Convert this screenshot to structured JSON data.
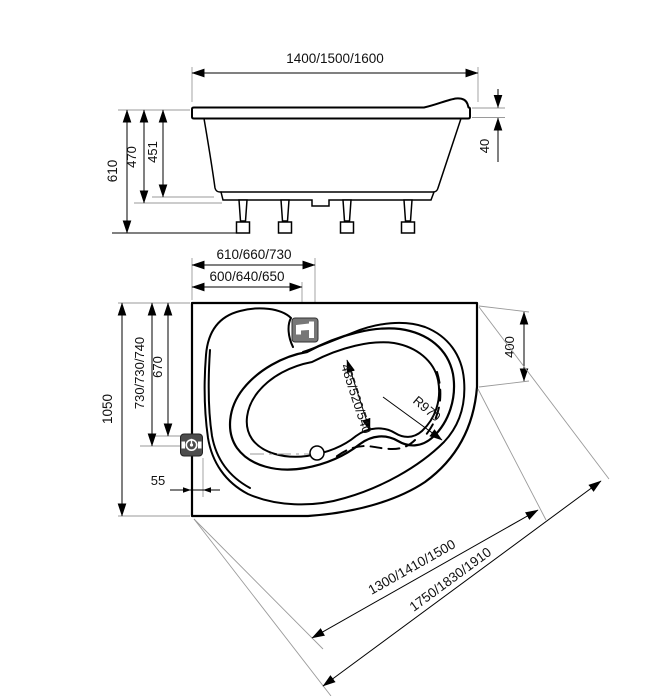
{
  "diagram": {
    "side_view": {
      "width_dim": "1400/1500/1600",
      "height_total": "610",
      "height_frame": "470",
      "height_shell": "451",
      "rim_thickness": "40"
    },
    "plan_view": {
      "drain_offset": "610/660/730",
      "faucet_offset": "600/640/650",
      "depth_total": "1050",
      "overflow_depth": "730/730/740",
      "well_depth": "670",
      "overflow_edge_offset": "55",
      "well_width": "485/520/540",
      "radius": "R970",
      "corner_edge": "400",
      "inner_diagonal": "1300/1410/1500",
      "outer_diagonal": "1750/1830/1910"
    }
  }
}
